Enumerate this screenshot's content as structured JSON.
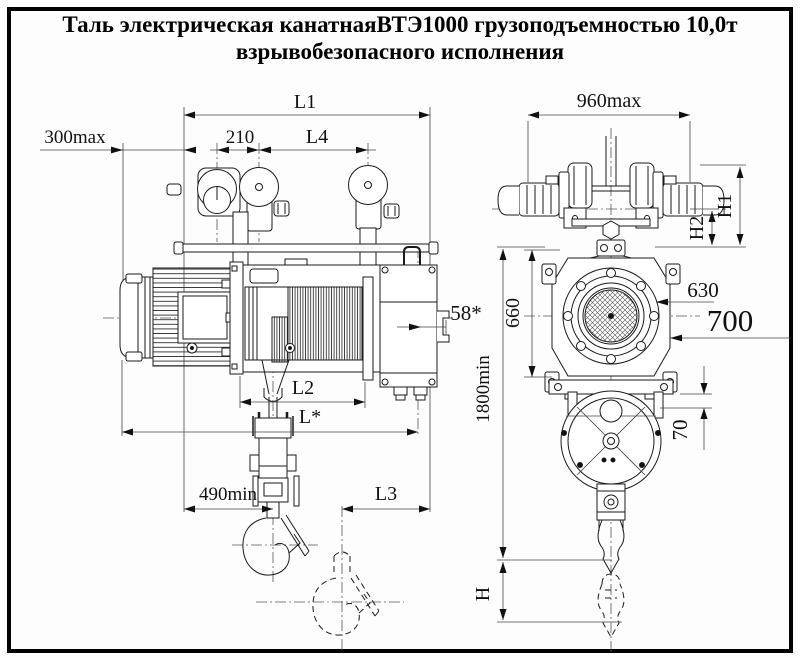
{
  "title": {
    "line1": "Таль электрическая канатнаяВТЭ1000 грузоподъемностью 10,0т",
    "line2": "взрывобезопасного исполнения"
  },
  "views": {
    "side": {
      "l1": "L1",
      "approach_300": "300max",
      "base_210": "210",
      "l4": "L4",
      "offset_58": "58*",
      "l2": "L2",
      "l_star": "L*",
      "min_490": "490min",
      "l3": "L3"
    },
    "front": {
      "width_960": "960max",
      "h1": "H1",
      "h2": "H2",
      "height_660": "660",
      "dia_630": "630",
      "dia_700": "700",
      "min_1800": "1800min",
      "gap_70": "70",
      "h": "H"
    }
  },
  "colors": {
    "line": "#1a1a1a",
    "background": "#fdfdfd",
    "border": "#000000",
    "text": "#111111"
  }
}
